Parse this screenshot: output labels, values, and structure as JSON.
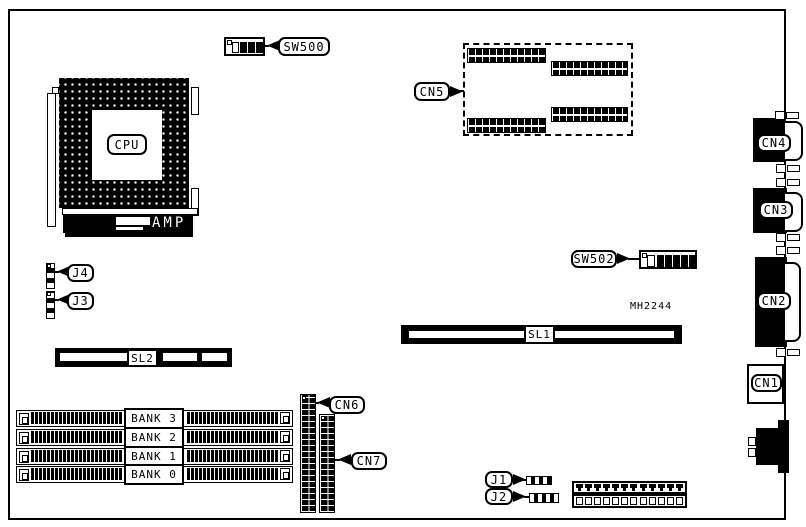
{
  "board": {
    "note": "MH2244",
    "colors": {
      "ink": "#000000",
      "paper": "#ffffff"
    }
  },
  "cpu": {
    "label": "CPU",
    "amp_label": "AMP"
  },
  "switches": {
    "sw500": "SW500",
    "sw502": "SW502"
  },
  "connectors": {
    "cn1": "CN1",
    "cn2": "CN2",
    "cn3": "CN3",
    "cn4": "CN4",
    "cn5": "CN5",
    "cn6": "CN6",
    "cn7": "CN7"
  },
  "jumpers": {
    "j1": "J1",
    "j2": "J2",
    "j3": "J3",
    "j4": "J4"
  },
  "slots": {
    "sl1": "SL1",
    "sl2": "SL2"
  },
  "memory": {
    "banks": [
      "BANK 3",
      "BANK 2",
      "BANK 1",
      "BANK 0"
    ]
  }
}
